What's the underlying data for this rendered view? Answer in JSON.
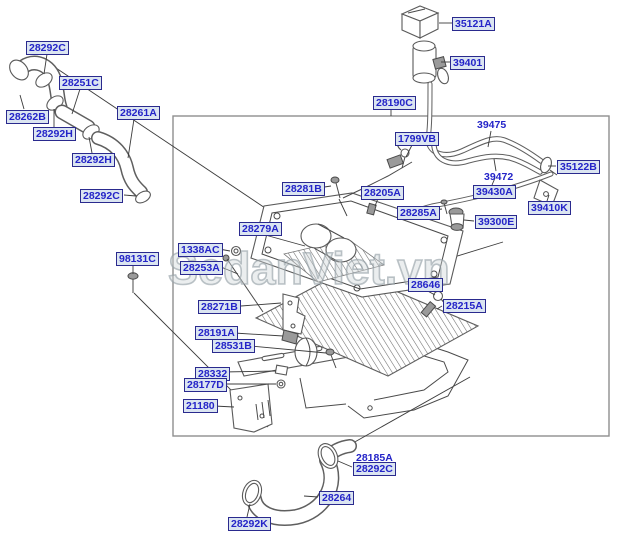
{
  "watermark": {
    "text": "SedanViet.vn",
    "color": "#b9c2c6"
  },
  "diagram": {
    "type": "exploded-parts-diagram",
    "label_style": {
      "text_color": "#2424c8",
      "box_background": "#dbe5f1",
      "box_border": "#2a2a8e"
    },
    "boxed_labels": [
      {
        "text": "28292C",
        "x": 26,
        "y": 41
      },
      {
        "text": "28251C",
        "x": 59,
        "y": 76
      },
      {
        "text": "28262B",
        "x": 6,
        "y": 110
      },
      {
        "text": "28292H",
        "x": 33,
        "y": 127
      },
      {
        "text": "28261A",
        "x": 117,
        "y": 106
      },
      {
        "text": "28292H",
        "x": 72,
        "y": 153
      },
      {
        "text": "28292C",
        "x": 80,
        "y": 189
      },
      {
        "text": "98131C",
        "x": 116,
        "y": 252
      },
      {
        "text": "35121A",
        "x": 452,
        "y": 17
      },
      {
        "text": "39401",
        "x": 450,
        "y": 56
      },
      {
        "text": "28190C",
        "x": 373,
        "y": 96
      },
      {
        "text": "1799VB",
        "x": 395,
        "y": 132
      },
      {
        "text": "35122B",
        "x": 557,
        "y": 160
      },
      {
        "text": "39430A",
        "x": 473,
        "y": 185
      },
      {
        "text": "39410K",
        "x": 528,
        "y": 201
      },
      {
        "text": "39300E",
        "x": 475,
        "y": 215
      },
      {
        "text": "28205A",
        "x": 361,
        "y": 186
      },
      {
        "text": "28285A",
        "x": 397,
        "y": 206
      },
      {
        "text": "28281B",
        "x": 282,
        "y": 182
      },
      {
        "text": "28279A",
        "x": 239,
        "y": 222
      },
      {
        "text": "1338AC",
        "x": 178,
        "y": 243
      },
      {
        "text": "28253A",
        "x": 180,
        "y": 261
      },
      {
        "text": "28271B",
        "x": 198,
        "y": 300
      },
      {
        "text": "28191A",
        "x": 195,
        "y": 326
      },
      {
        "text": "28531B",
        "x": 212,
        "y": 339
      },
      {
        "text": "28332",
        "x": 195,
        "y": 367
      },
      {
        "text": "28177D",
        "x": 184,
        "y": 378
      },
      {
        "text": "21180",
        "x": 183,
        "y": 399
      },
      {
        "text": "28646",
        "x": 408,
        "y": 278
      },
      {
        "text": "28215A",
        "x": 443,
        "y": 299
      },
      {
        "text": "28292C",
        "x": 353,
        "y": 462
      },
      {
        "text": "28264",
        "x": 319,
        "y": 491
      },
      {
        "text": "28292K",
        "x": 228,
        "y": 517
      }
    ],
    "plain_labels": [
      {
        "text": "39475",
        "x": 477,
        "y": 119
      },
      {
        "text": "39472",
        "x": 484,
        "y": 171
      },
      {
        "text": "28185A",
        "x": 356,
        "y": 452
      }
    ]
  }
}
